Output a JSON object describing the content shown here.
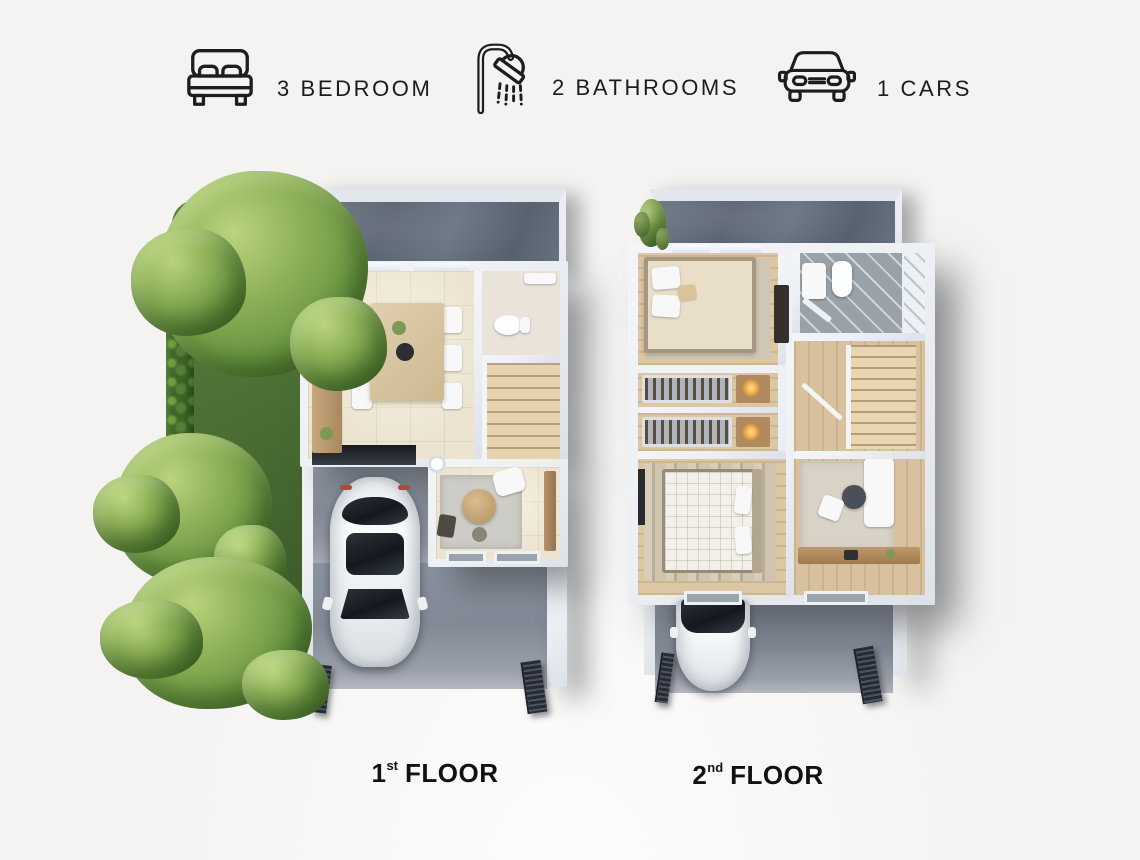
{
  "features": {
    "items": [
      {
        "icon": "bed-icon",
        "label": "3 BEDROOM"
      },
      {
        "icon": "shower-icon",
        "label": "2 BATHROOMS"
      },
      {
        "icon": "car-icon",
        "label": "1 CARS"
      }
    ]
  },
  "floor_labels": [
    {
      "number": "1",
      "ordinal": "st",
      "word": "FLOOR"
    },
    {
      "number": "2",
      "ordinal": "nd",
      "word": "FLOOR"
    }
  ],
  "colors": {
    "background": "#f4f3f1",
    "text": "#1c1c1c",
    "terrace": "#67707e",
    "wall": "#edf0f4",
    "floor_beige": "#ece4d1",
    "floor_wood": "#dcc7a4",
    "wood_dark": "#b08a5e",
    "grass": "#4c6f34",
    "tree": "#7aa544",
    "hedge": "#3f6527",
    "driveway": "#8e949e",
    "gate": "#343a44",
    "car": "#f2f4f6",
    "glass": "#22262c",
    "bath_gray": "#99a1a9"
  }
}
